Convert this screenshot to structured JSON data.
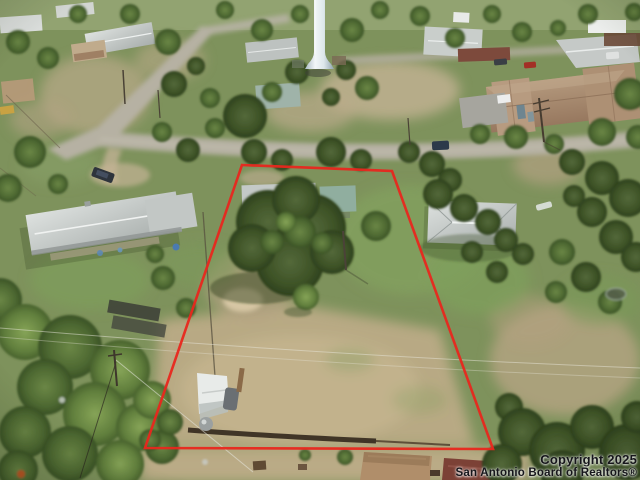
{
  "image": {
    "kind": "aerial-drone-photo",
    "subject": "vacant residential lot outlined with red boundary lines",
    "boundary_color": "#e8271d"
  },
  "watermark": {
    "line1": "Copyright 2025",
    "line2": "San Antonio Board of Realtors®"
  }
}
